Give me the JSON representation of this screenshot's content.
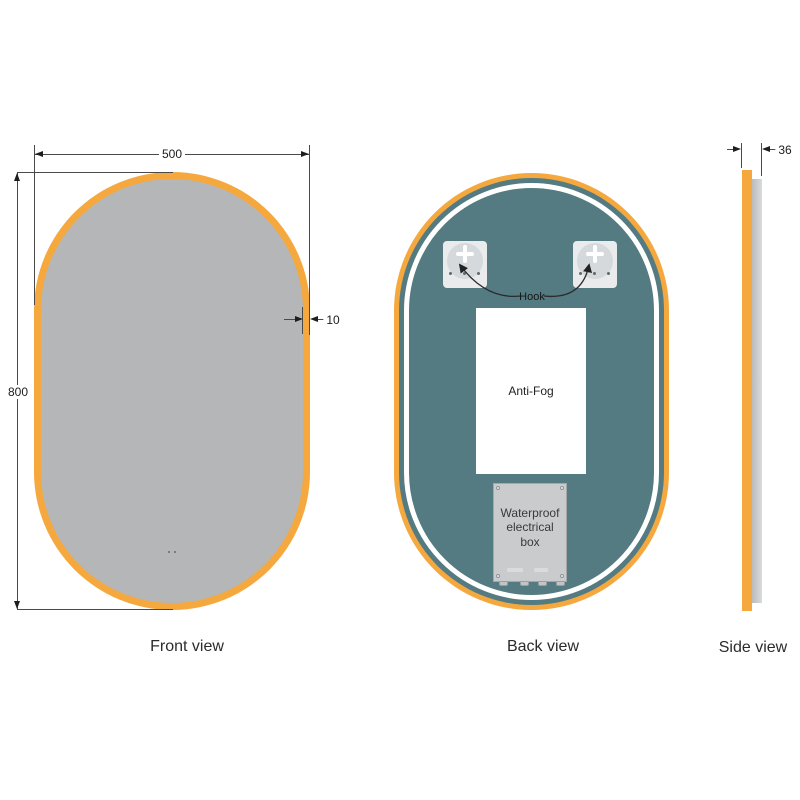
{
  "colors": {
    "frame_orange": "#F5A83E",
    "mirror_gray": "#B5B6B7",
    "back_panel_teal": "#547B82",
    "led_ring_white": "#FFFFFF",
    "dimension_line": "#4A4A4A",
    "hook_plate_gray": "#E9EBEC",
    "electrical_box_gray": "#C9CBCD"
  },
  "front_view": {
    "label": "Front view",
    "width_dimension": "500",
    "height_dimension": "800",
    "frame_thickness_dimension": "10"
  },
  "back_view": {
    "label": "Back view",
    "hook_label": "Hook",
    "anti_fog_label": "Anti-Fog",
    "electrical_box_label": "Waterproof electrical box"
  },
  "side_view": {
    "label": "Side view",
    "depth_dimension": "36"
  }
}
